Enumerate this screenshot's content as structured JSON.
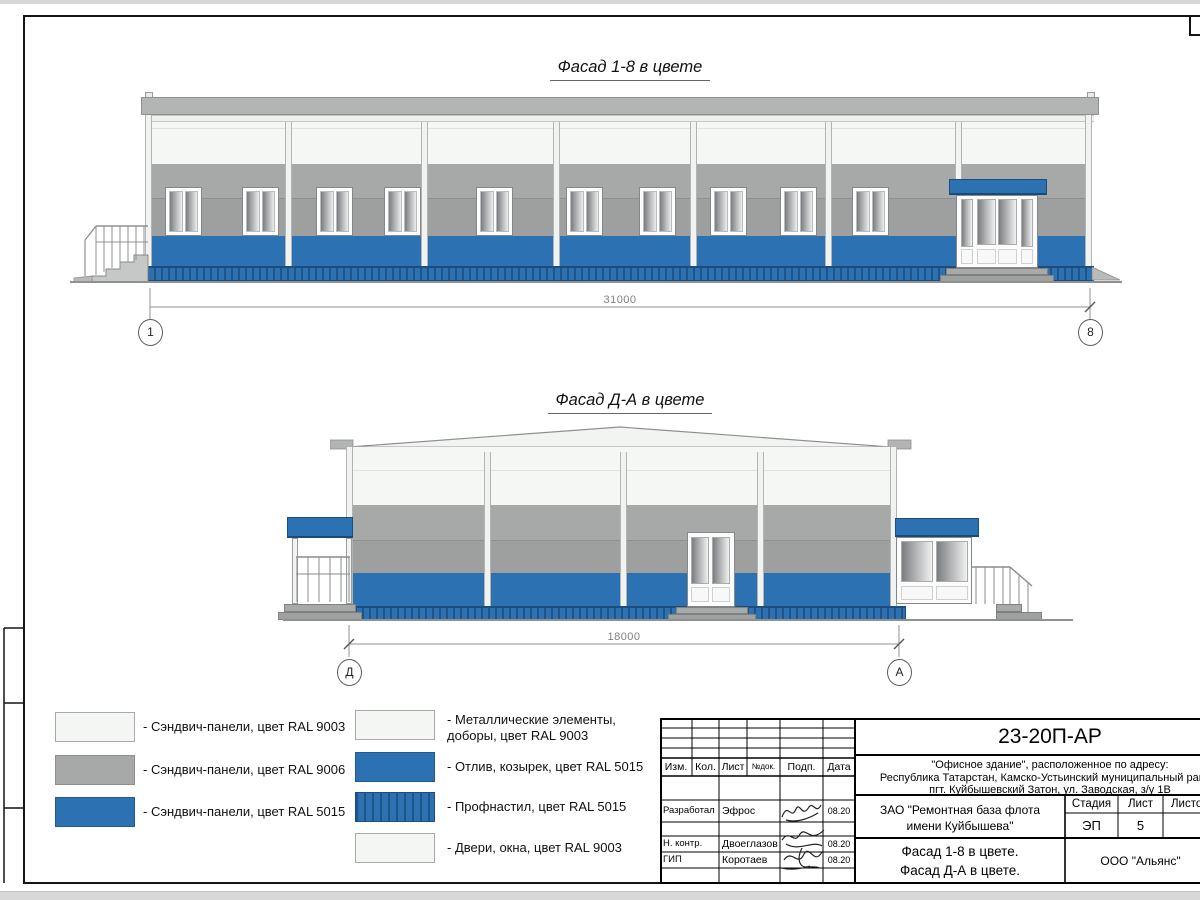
{
  "sheet": {
    "facade1": {
      "title": "Фасад 1-8 в цвете",
      "dim": "31000",
      "axisL": "1",
      "axisR": "8"
    },
    "facade2": {
      "title": "Фасад Д-А в цвете",
      "dim": "18000",
      "axisL": "Д",
      "axisR": "А"
    },
    "legend": {
      "col1": [
        {
          "label": "- Сэндвич-панели, цвет RAL 9003",
          "swatch": "white"
        },
        {
          "label": "- Сэндвич-панели, цвет RAL 9006",
          "swatch": "gray"
        },
        {
          "label": "- Сэндвич-панели, цвет RAL 5015",
          "swatch": "blue"
        }
      ],
      "col2": [
        {
          "label": "- Металлические элементы,\nдоборы, цвет RAL 9003",
          "swatch": "white"
        },
        {
          "label": "- Отлив, козырек, цвет RAL 5015",
          "swatch": "blue"
        },
        {
          "label": "- Профнастил, цвет RAL 5015",
          "swatch": "blue-striped"
        },
        {
          "label": "- Двери, окна, цвет RAL 9003",
          "swatch": "white"
        }
      ]
    },
    "titleblock": {
      "doc": "23-20П-АР",
      "addr1": "\"Офисное здание\", расположенное по адресу:",
      "addr2": "Республика Татарстан, Камско-Устьинский муниципальный район,",
      "addr3": "пгт. Куйбышевский Затон, ул. Заводская, з/у 1В",
      "client1": "ЗАО \"Ремонтная база флота",
      "client2": "имени Куйбышева\"",
      "cols": {
        "izm": "Изм.",
        "kol": "Кол.",
        "list": "Лист",
        "ndok": "№док.",
        "podp": "Подп.",
        "data": "Дата"
      },
      "stage": {
        "label": "Стадия",
        "value": "ЭП"
      },
      "sheetno": {
        "label": "Лист",
        "value": "5"
      },
      "sheets": {
        "label": "Листов",
        "value": ""
      },
      "rows": [
        {
          "role": "Разработал",
          "name": "Эфрос",
          "date": "08.20"
        },
        {
          "role": "Н. контр.",
          "name": "Двоеглазов",
          "date": "08.20"
        },
        {
          "role": "ГИП",
          "name": "Коротаев",
          "date": "08.20"
        }
      ],
      "titleLine1": "Фасад 1-8 в цвете.",
      "titleLine2": "Фасад Д-А в цвете.",
      "company": "ООО \"Альянс\""
    },
    "colors": {
      "blue_ral5015": "#2c72b3",
      "gray_ral9006": "#a7a9a8",
      "white_ral9003": "#f5f7f4",
      "profnastil_stripe": "#1c4d7c"
    }
  }
}
